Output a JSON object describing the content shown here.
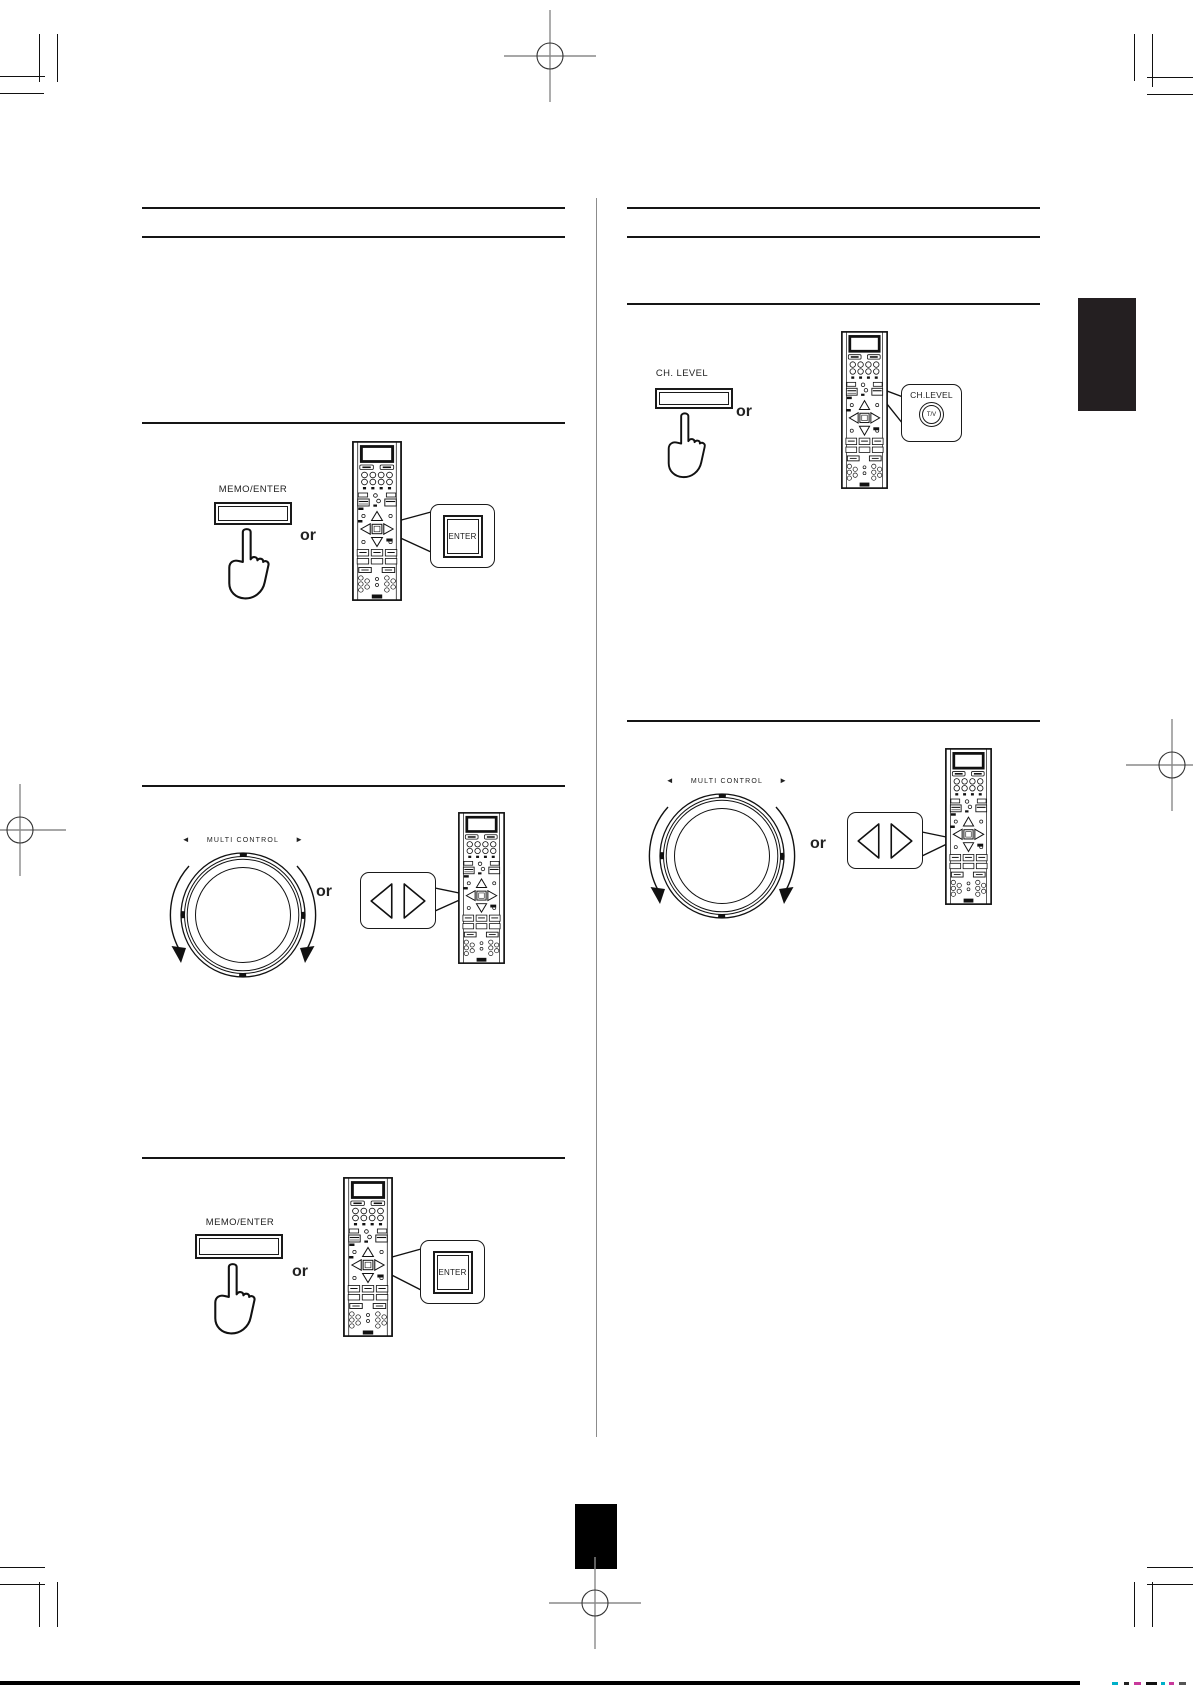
{
  "colors": {
    "ink": "#1a1a1a",
    "divider_gray": "#8c8c8c",
    "section_tab": "#241f21",
    "page_block": "#000000"
  },
  "sections": {
    "l1": {
      "button_label": "MEMO/ENTER",
      "or_label": "or",
      "callout_key_label": "ENTER"
    },
    "l2": {
      "dial_label": "MULTI CONTROL",
      "dial_left_arrow": "◄",
      "dial_right_arrow": "►",
      "or_label": "or"
    },
    "l3": {
      "button_label": "MEMO/ENTER",
      "or_label": "or",
      "callout_key_label": "ENTER"
    },
    "r1": {
      "button_label": "CH. LEVEL",
      "or_label": "or",
      "callout_label": "CH.LEVEL",
      "callout_key_label": "T/V"
    },
    "r2": {
      "dial_label": "MULTI CONTROL",
      "dial_left_arrow": "◄",
      "dial_right_arrow": "►",
      "or_label": "or"
    }
  }
}
